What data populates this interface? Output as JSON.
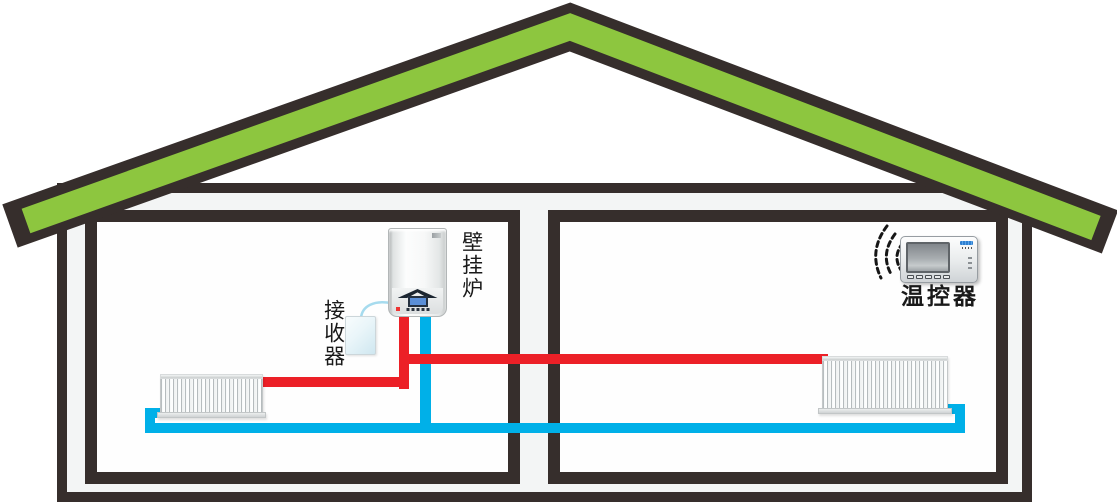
{
  "labels": {
    "boiler": "壁挂炉",
    "receiver": "接收器",
    "thermostat": "温控器"
  },
  "colors": {
    "roof_green": "#8dc63f",
    "outline_dark": "#362e2c",
    "hot_pipe_red": "#ec2027",
    "cold_pipe_blue": "#00b0e8",
    "wall_fill": "#f3f5f5"
  },
  "components": [
    "roof",
    "house-wall",
    "room-left",
    "room-right",
    "wall-hung-boiler",
    "wireless-receiver",
    "thermostat",
    "radiator-left",
    "radiator-right",
    "hot-water-supply-pipe",
    "cold-water-return-pipe",
    "wireless-signal"
  ]
}
